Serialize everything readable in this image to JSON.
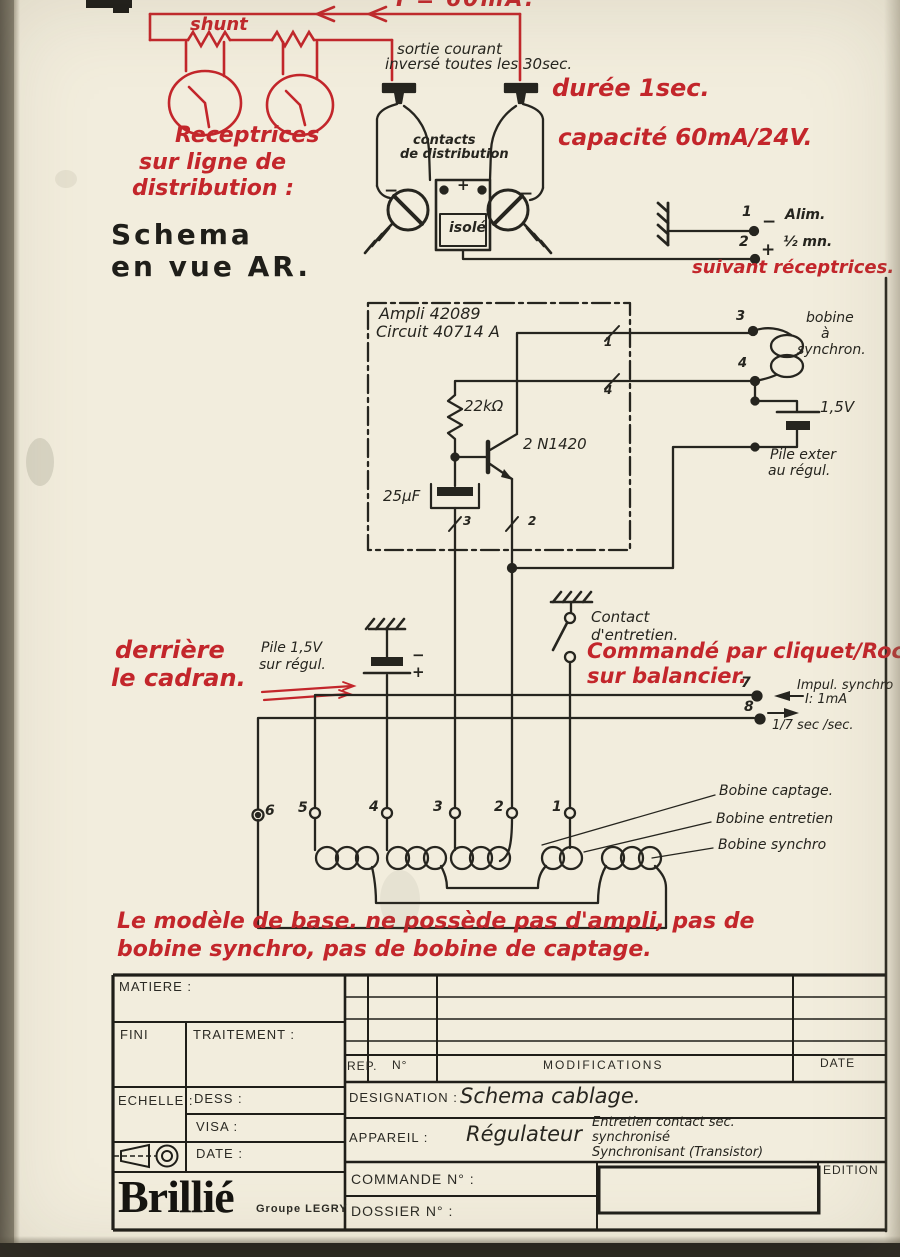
{
  "red_notes": {
    "current": "I = 60mA.",
    "shunt": "shunt",
    "receptrices": [
      "Receptrices",
      "sur ligne de",
      "distribution :"
    ],
    "duree": "durée 1sec.",
    "capacite": "capacité 60mA/24V.",
    "suivant": "suivant réceptrices.",
    "derriere": [
      "derrière",
      "le cadran."
    ],
    "commande": "Commandé par cliquet/Rochet",
    "balancier": "sur balancier.",
    "note_bas": [
      "Le modèle de base.  ne possède pas d'ampli, pas de",
      "bobine synchro, pas de bobine de captage."
    ]
  },
  "schematic": {
    "sortie": [
      "sortie courant",
      "inversé toutes les 30sec."
    ],
    "vue": [
      "Schema",
      "en vue AR."
    ],
    "contacts": [
      "contacts",
      "de distribution"
    ],
    "isole": "isolé",
    "signs": {
      "plus": "+",
      "minus": "−"
    },
    "alim": {
      "borne1": "1",
      "label1": "Alim.",
      "borne2": "2",
      "label2": "½ mn."
    },
    "ampli": [
      "Ampli 42089",
      "Circuit 40714 A"
    ],
    "r1": "22kΩ",
    "q1": "2 N1420",
    "c1": "25μF",
    "bobine_synchron": [
      "bobine",
      "à",
      "synchron."
    ],
    "pile_ext_v": "1,5V",
    "pile_ext": [
      "Pile exter",
      "au régul."
    ],
    "pile_reg": [
      "Pile 1,5V",
      "sur régul."
    ],
    "contact": [
      "Contact",
      "d'entretien."
    ],
    "borne7": "7",
    "borne8": "8",
    "impul": [
      "Impul. synchro",
      "I: 1mA"
    ],
    "freq": "1/7 sec /sec.",
    "bobines": [
      "Bobine captage.",
      "Bobine entretien",
      "Bobine synchro"
    ],
    "bornes_bas": [
      "6",
      "5",
      "4",
      "3",
      "2",
      "1"
    ],
    "marks": {
      "m1": "1",
      "m2": "2",
      "m3": "3",
      "m4": "4"
    },
    "coil_bornes": {
      "b3": "3",
      "b4": "4"
    }
  },
  "title_block": {
    "matiere": "MATIERE :",
    "fini": "FINI",
    "traitement": "TRAITEMENT :",
    "echelle": "ECHELLE :",
    "dess": "DESS :",
    "visa": "VISA :",
    "date": "DATE :",
    "rep": "REP.",
    "no": "N°",
    "modifications": "MODIFICATIONS",
    "date_col": "DATE",
    "designation_label": "DESIGNATION :",
    "designation_value": "Schema cablage.",
    "appareil_label": "APPAREIL :",
    "appareil_value": "Régulateur",
    "appareil_detail": [
      "Entretien contact sec.",
      "synchronisé",
      "Synchronisant   (Transistor)"
    ],
    "commande": "COMMANDE N° :",
    "dossier": "DOSSIER N° :",
    "edition": "EDITION",
    "brand": "Brillié",
    "brand_sub": "Groupe LEGRY"
  }
}
